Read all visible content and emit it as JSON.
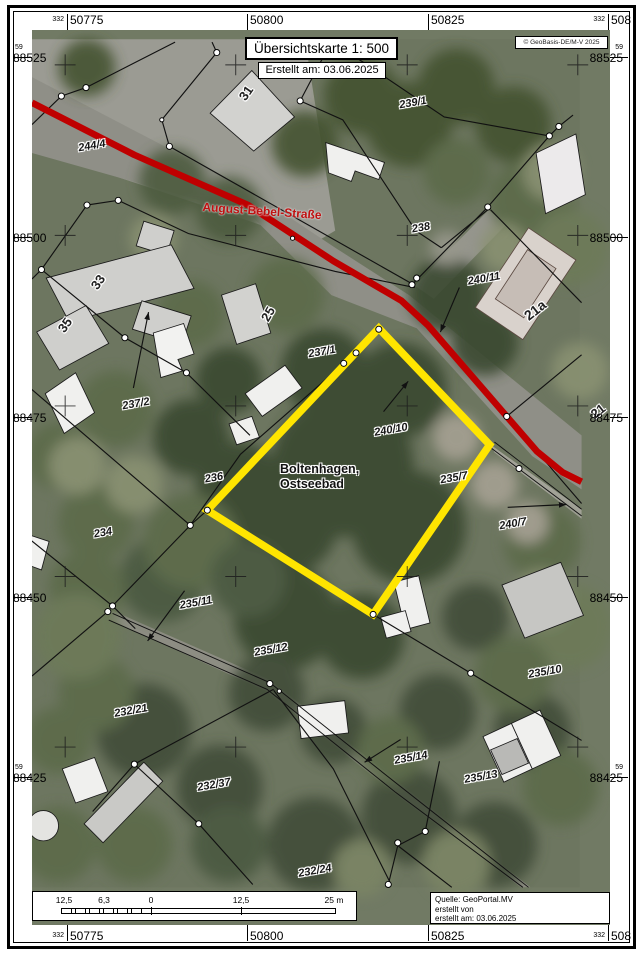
{
  "map": {
    "title": "Übersichtskarte 1: 500",
    "created": "Erstellt am: 03.06.2025",
    "copyright": "© GeoBasis-DE/M-V 2025",
    "source": {
      "line1": "Quelle: GeoPortal.MV",
      "line2": "erstellt von",
      "line3": "erstellt am: 03.06.2025"
    },
    "street": "August-Bebel-Straße",
    "place": {
      "line1": "Boltenhagen,",
      "line2": "Ostseebad"
    }
  },
  "grid": {
    "x_small": "332",
    "y_small": "59",
    "x": [
      "50775",
      "50800",
      "50825",
      "50850"
    ],
    "y": [
      "88525",
      "88500",
      "88475",
      "88450",
      "88425"
    ]
  },
  "scalebar": {
    "labels": [
      "12,5",
      "6,3",
      "0",
      "12,5",
      "25 m"
    ]
  },
  "parcels": [
    {
      "text": "244/4"
    },
    {
      "text": "31"
    },
    {
      "text": "239/1"
    },
    {
      "text": "238"
    },
    {
      "text": "240/11"
    },
    {
      "text": "21a"
    },
    {
      "text": "33"
    },
    {
      "text": "35"
    },
    {
      "text": "25"
    },
    {
      "text": "237/1"
    },
    {
      "text": "237/2"
    },
    {
      "text": "240/10"
    },
    {
      "text": "236"
    },
    {
      "text": "235/7"
    },
    {
      "text": "240/7"
    },
    {
      "text": "21"
    },
    {
      "text": "234"
    },
    {
      "text": "235/11"
    },
    {
      "text": "235/12"
    },
    {
      "text": "232/21"
    },
    {
      "text": "235/10"
    },
    {
      "text": "235/14"
    },
    {
      "text": "235/13"
    },
    {
      "text": "232/37"
    },
    {
      "text": "232/24"
    }
  ],
  "colors": {
    "road": "#bf0000",
    "highlight": "#ffe500"
  }
}
